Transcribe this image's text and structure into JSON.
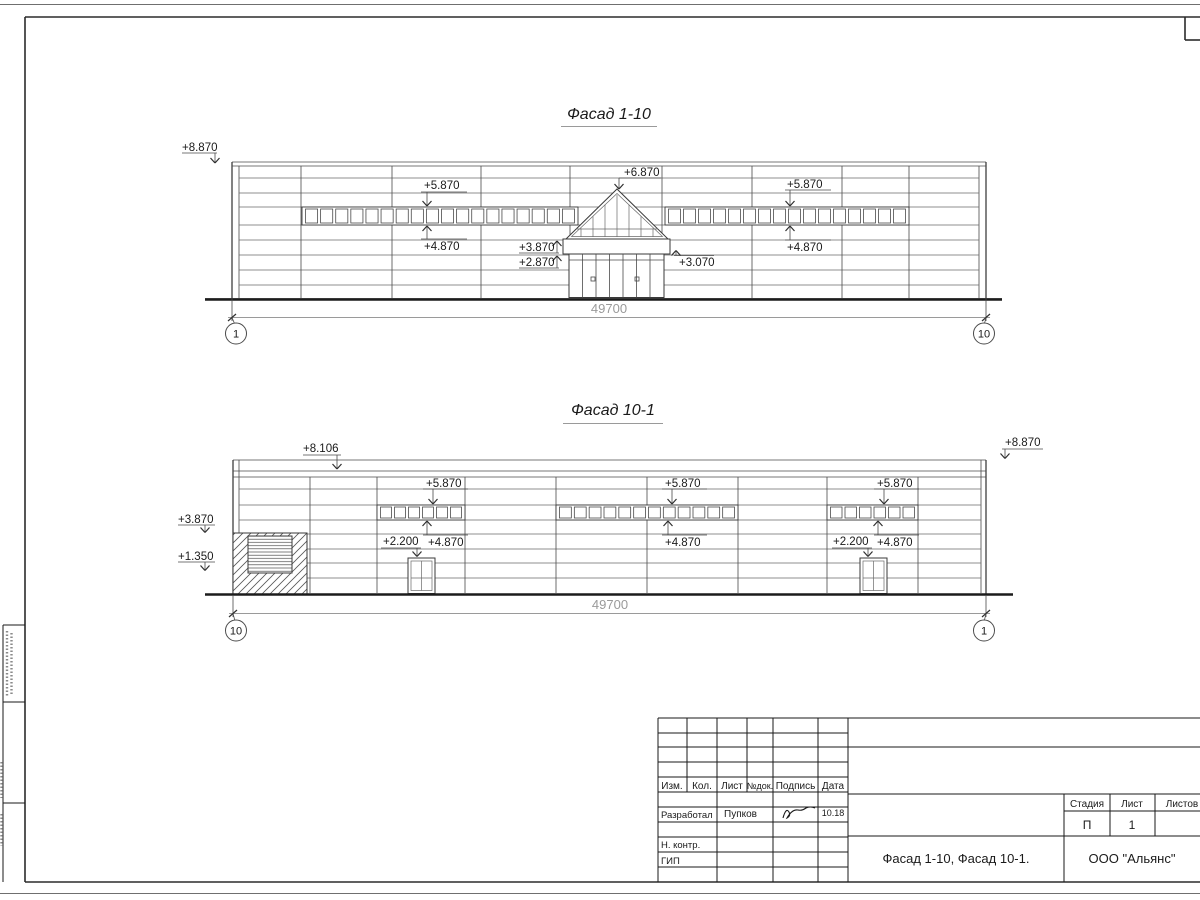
{
  "facade_1_10": {
    "title": "Фасад 1-10",
    "dimension": "49700",
    "axis_left": "1",
    "axis_right": "10",
    "elev": {
      "parapet_left": "+8.870",
      "band_left_top": "+5.870",
      "band_left_bottom": "+4.870",
      "gable_top": "+6.870",
      "canopy_top": "+3.870",
      "canopy_bottom": "+2.870",
      "canopy_side": "+3.070",
      "band_right_top": "+5.870",
      "band_right_bottom": "+4.870"
    }
  },
  "facade_10_1": {
    "title": "Фасад 10-1",
    "dimension": "49700",
    "axis_left": "10",
    "axis_right": "1",
    "elev": {
      "parapet_left": "+8.106",
      "parapet_right": "+8.870",
      "wall_top": "+3.870",
      "wall_bottom": "+1.350",
      "band_a_top": "+5.870",
      "band_a_bottom": "+4.870",
      "door_a": "+2.200",
      "band_b_top": "+5.870",
      "band_b_bottom": "+4.870",
      "band_c_top": "+5.870",
      "band_c_bottom": "+4.870",
      "door_b": "+2.200"
    }
  },
  "title_block": {
    "headers": {
      "izm": "Изм.",
      "kol": "Кол.",
      "list": "Лист",
      "ndok": "№док.",
      "podpis": "Подпись",
      "data": "Дата"
    },
    "rows": {
      "razrabotal": "Разработал",
      "nkontr": "Н. контр.",
      "gip": "ГИП"
    },
    "razrabotal_name": "Пупков",
    "razrabotal_date": "10.18",
    "doc_title": "Фасад 1-10, Фасад 10-1.",
    "org": "ООО \"Альянс\"",
    "stadiya_label": "Стадия",
    "list_label": "Лист",
    "listov_label": "Листов",
    "stadiya": "П",
    "list_num": "1"
  }
}
